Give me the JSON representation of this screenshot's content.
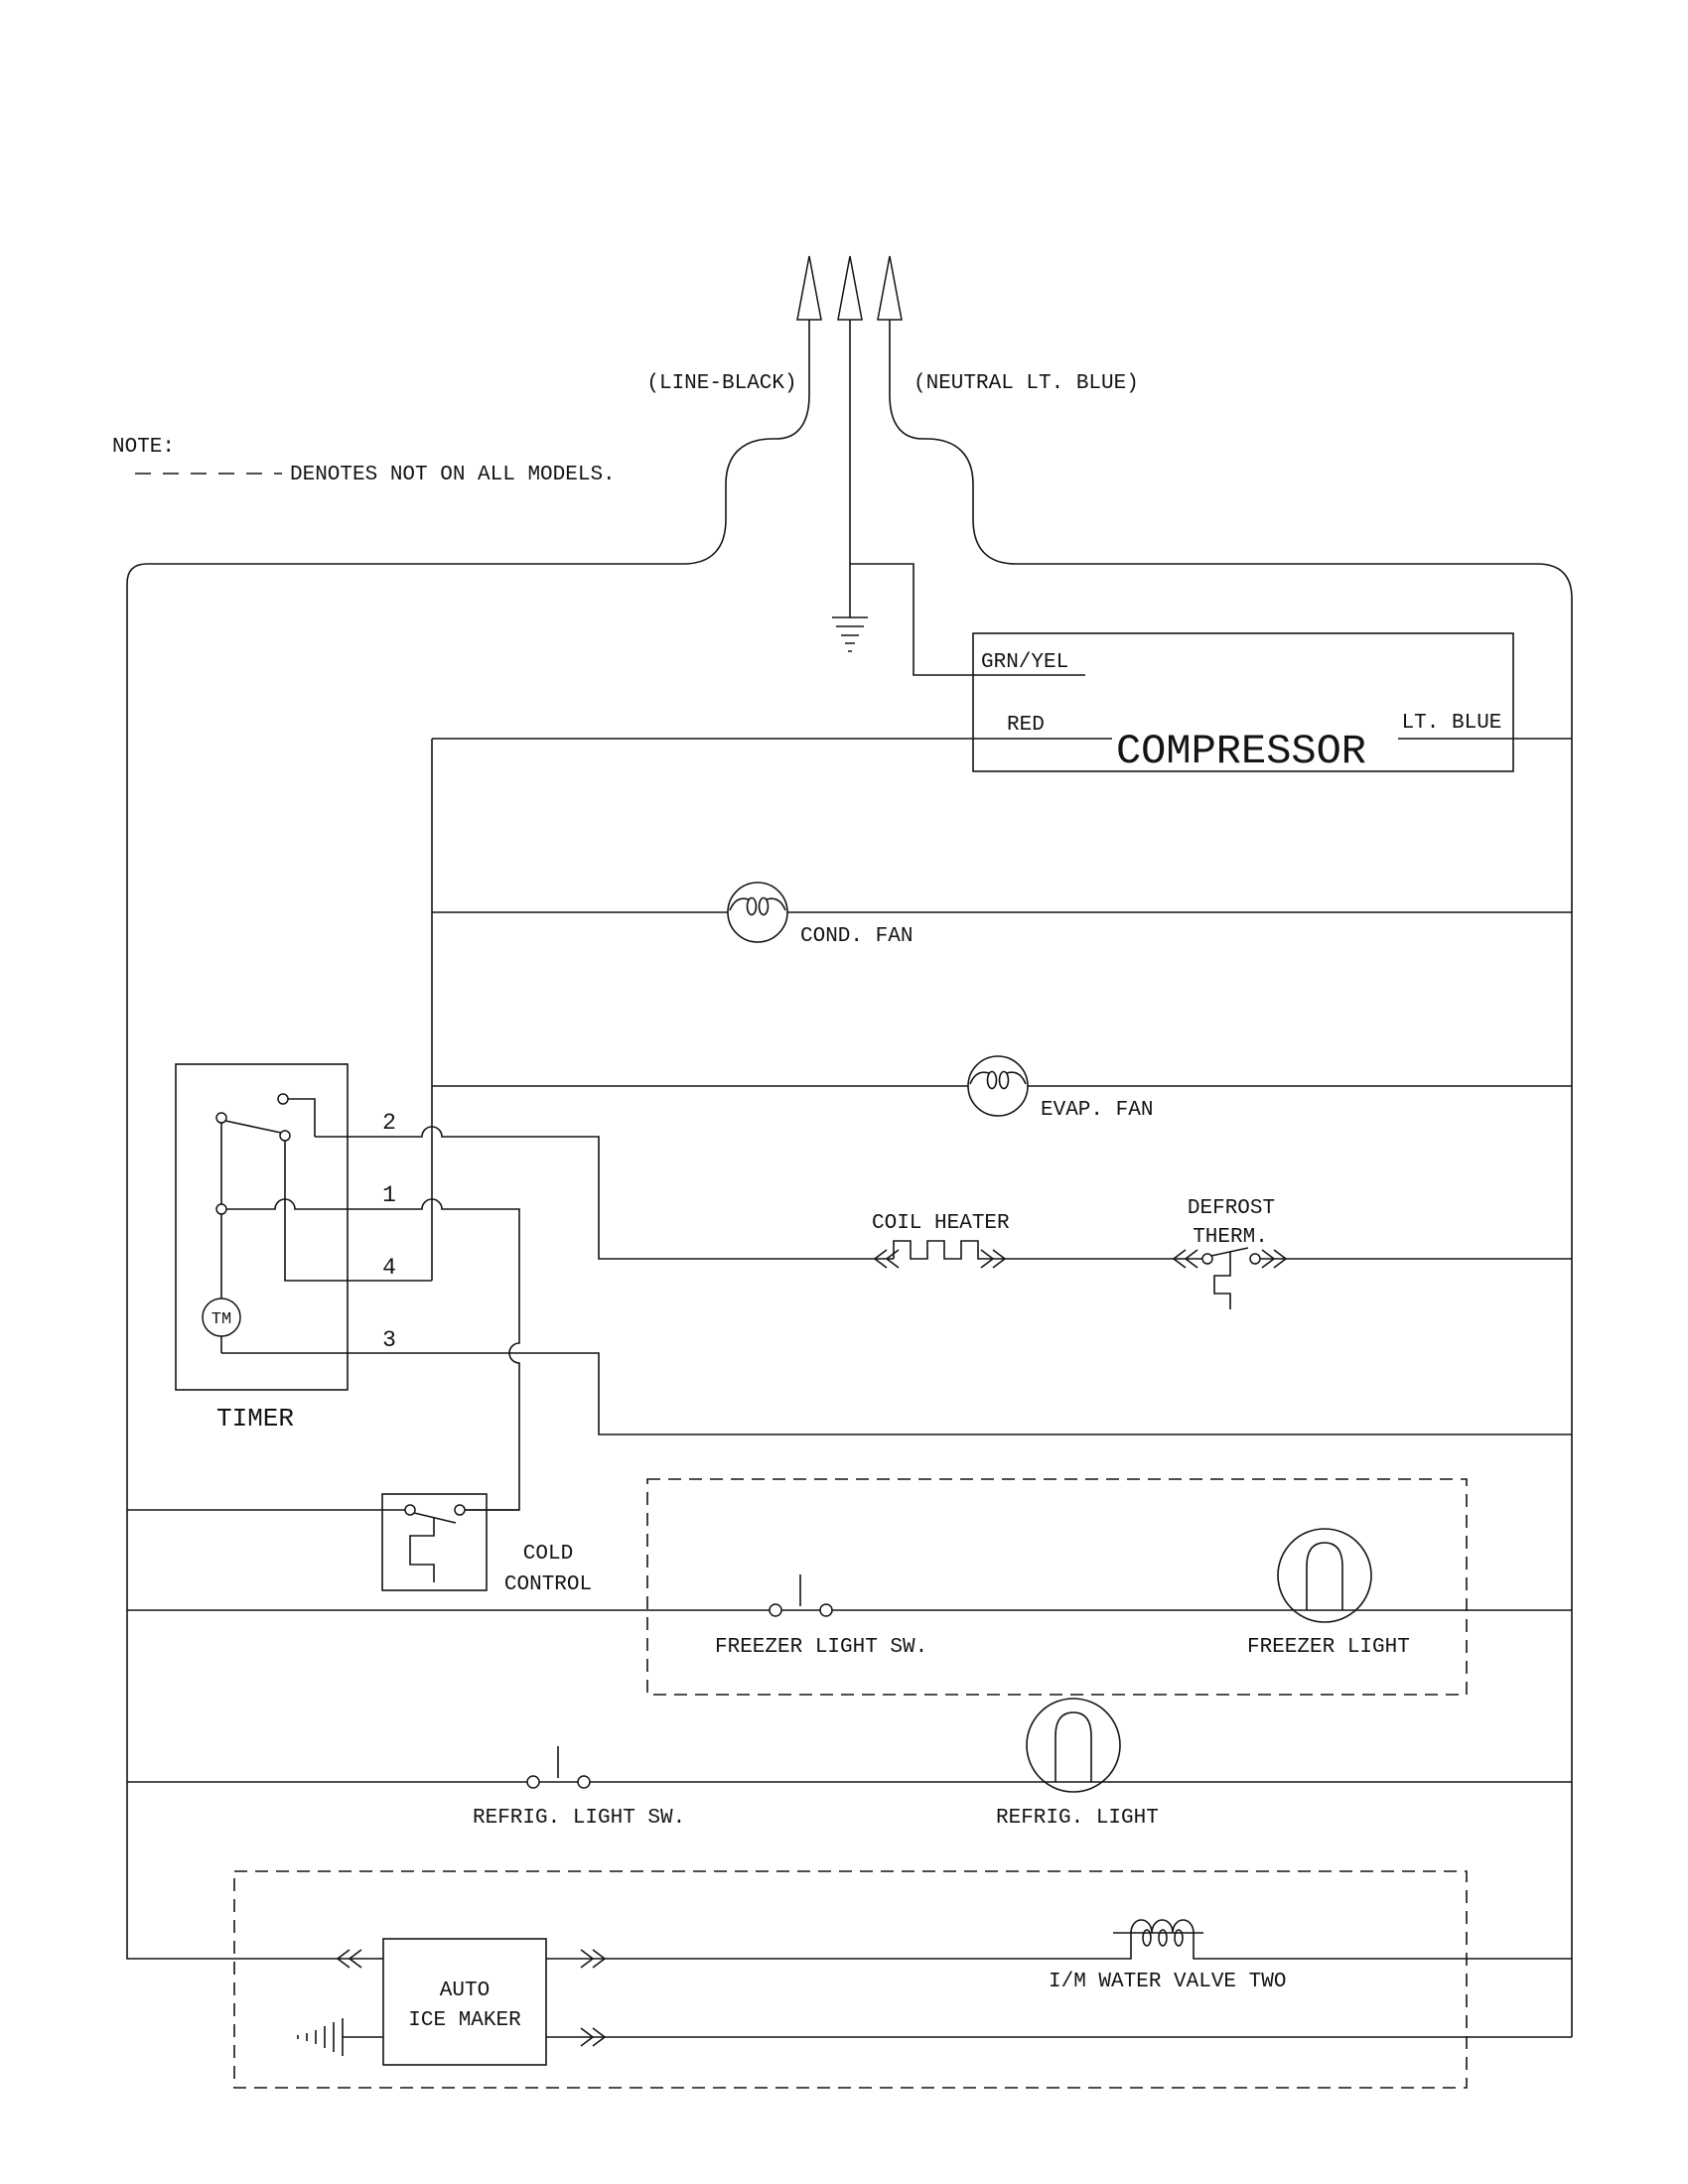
{
  "note": {
    "title": "NOTE:",
    "legend_text": "DENOTES NOT ON ALL MODELS."
  },
  "supply": {
    "line": "(LINE-BLACK)",
    "neutral": "(NEUTRAL LT. BLUE)"
  },
  "compressor": {
    "title": "COMPRESSOR",
    "ground_wire": "GRN/YEL",
    "run_wire": "RED",
    "neutral_wire": "LT. BLUE"
  },
  "fans": {
    "cond": "COND. FAN",
    "evap": "EVAP. FAN"
  },
  "defrost": {
    "heater": "COIL HEATER",
    "therm_line1": "DEFROST",
    "therm_line2": "THERM."
  },
  "timer": {
    "title": "TIMER",
    "motor": "TM",
    "terminal_2": "2",
    "terminal_1": "1",
    "terminal_4": "4",
    "terminal_3": "3"
  },
  "cold_control": {
    "line1": "COLD",
    "line2": "CONTROL"
  },
  "freezer": {
    "switch": "FREEZER LIGHT SW.",
    "light": "FREEZER LIGHT"
  },
  "refrigerator": {
    "switch": "REFRIG. LIGHT SW.",
    "light": "REFRIG. LIGHT"
  },
  "ice_maker": {
    "line1": "AUTO",
    "line2": "ICE MAKER",
    "valve": "I/M WATER VALVE TWO"
  }
}
